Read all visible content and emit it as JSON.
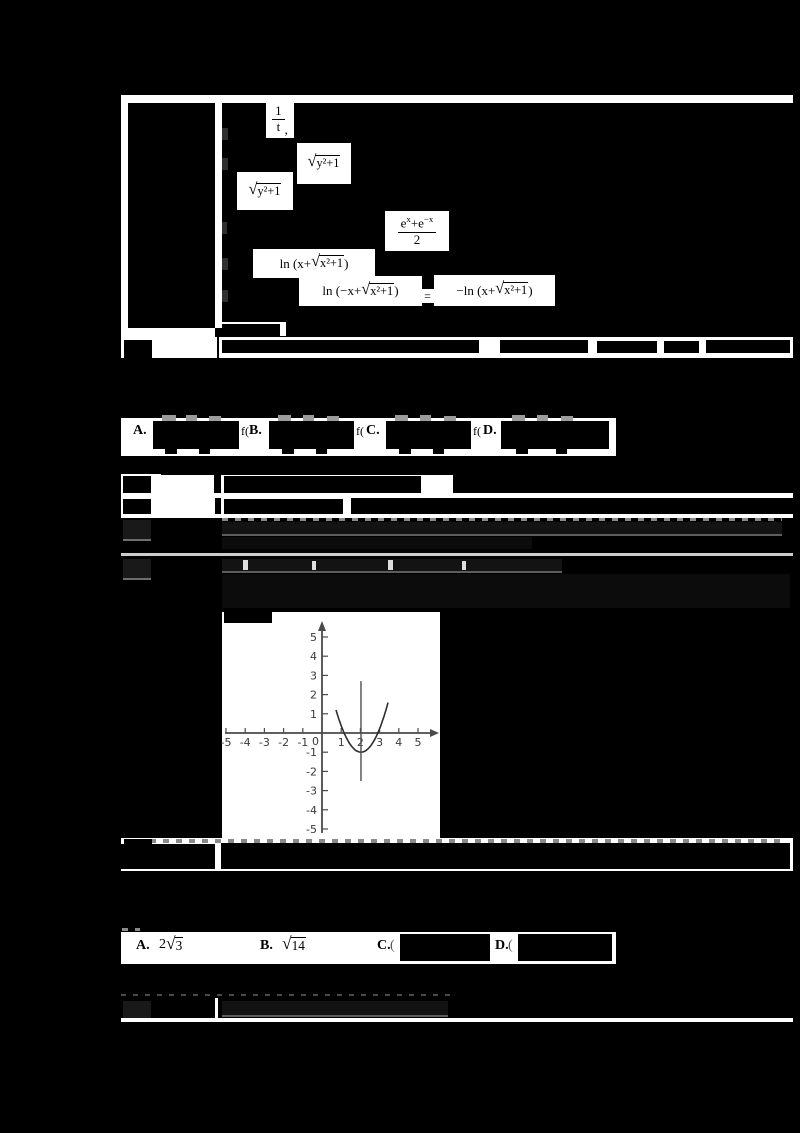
{
  "colors": {
    "page_bg": "#000000",
    "paper": "#ffffff",
    "axis": "#4a4a4a",
    "curve": "#2e2e2e",
    "tick_label": "#3a3a3a",
    "vline": "#4f4f4f"
  },
  "table1": {
    "formulas": {
      "frac_t": {
        "num": "1",
        "den": "t",
        "after": ","
      },
      "sqrt_upper": {
        "radicand": "y²+1"
      },
      "sqrt_lower": {
        "radicand": "y²+1"
      },
      "cosh": {
        "b1": "e",
        "s1": "x",
        "b2": "+e",
        "s2": "−x",
        "den": "2"
      },
      "ln_pos": {
        "pre": "ln (x+",
        "radicand": "x²+1",
        "after": ")"
      },
      "ln_neg": {
        "pre": "ln (−x+",
        "radicand": "x²+1",
        "after": ")"
      },
      "equals": "=",
      "ln_rhs": {
        "pre": "−ln (x+",
        "radicand": "x²+1",
        "after": ")"
      }
    },
    "closing_ghost": "故选：C．"
  },
  "review1": {
    "label": "点评"
  },
  "q1": {
    "options": [
      {
        "letter": "A."
      },
      {
        "letter": "B."
      },
      {
        "letter": "C."
      },
      {
        "letter": "D."
      }
    ],
    "tail": "f("
  },
  "table2": {
    "kaodian_label": "考点",
    "kaodian_content": "二次函数的图象；二次函数的性质",
    "zhuanti_label": "专题",
    "zhuanti_content": "压轴题；数形结合．",
    "fenxi_label": "分析",
    "jieda_label": "解答",
    "dianping_label": "点评"
  },
  "chart_data": {
    "type": "line",
    "title": "",
    "xlabel": "",
    "ylabel": "",
    "grid": false,
    "xlim": [
      -5.2,
      6.0
    ],
    "ylim": [
      -5.3,
      5.8
    ],
    "x_ticks": [
      -5,
      -4,
      -3,
      -2,
      -1,
      1,
      2,
      3,
      4,
      5
    ],
    "y_ticks": [
      5,
      4,
      3,
      2,
      1,
      -1,
      -2,
      -3,
      -4,
      -5
    ],
    "origin_label": "0",
    "series": [
      {
        "name": "parabola",
        "type": "quadratic",
        "a": 1.3,
        "h": 2.03,
        "k": -1,
        "x_min": 0.73,
        "x_max": 3.44,
        "vertex": [
          2,
          -1
        ],
        "x_intercepts": [
          1.15,
          2.9
        ]
      },
      {
        "name": "axis-of-symmetry",
        "type": "vertical-segment",
        "x": 2.03,
        "y_min": -2.5,
        "y_max": 2.7
      }
    ]
  },
  "q2": {
    "options": [
      {
        "letter": "A.",
        "coeff": "2",
        "radicand": "3"
      },
      {
        "letter": "B.",
        "coeff": "",
        "radicand": "14"
      },
      {
        "letter": "C.",
        "paren": "("
      },
      {
        "letter": "D.",
        "paren": "("
      }
    ]
  },
  "table3": {
    "kaodian_label": "考点"
  }
}
